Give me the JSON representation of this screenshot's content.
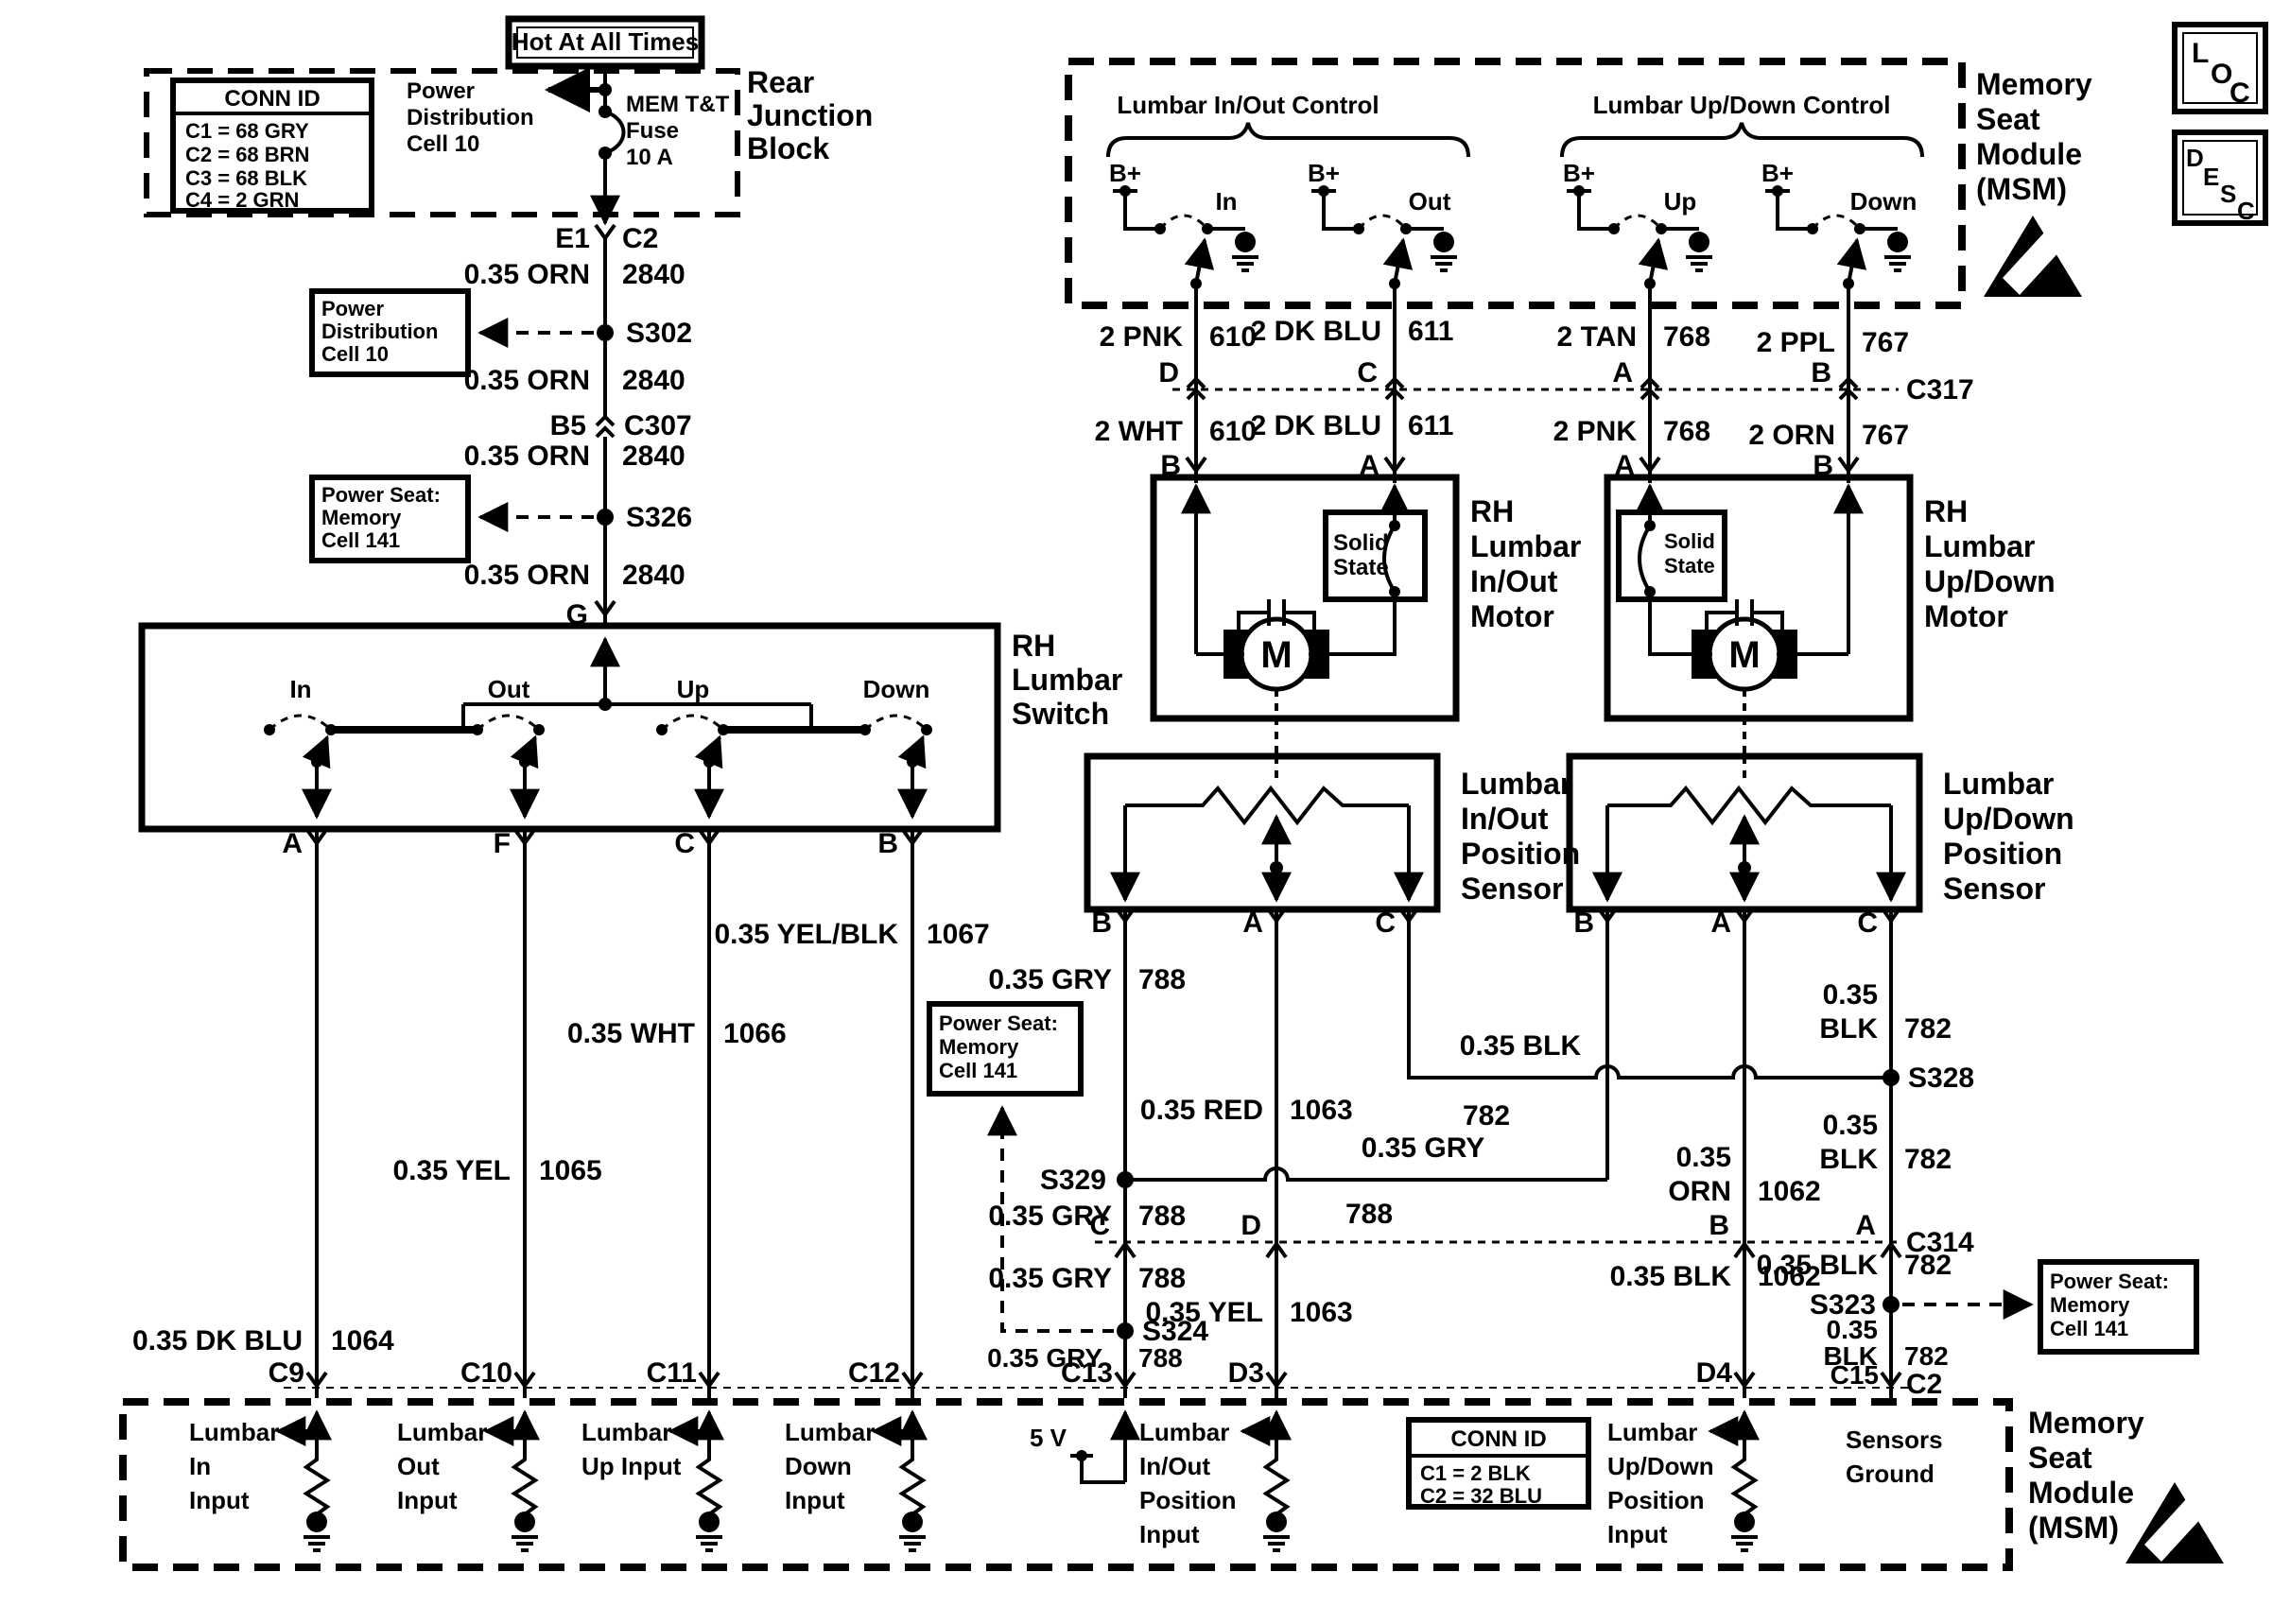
{
  "colors": {
    "ink": "#000000",
    "paper": "#ffffff"
  },
  "nav": {
    "loc": [
      "L",
      "O",
      "C"
    ],
    "desc": [
      "D",
      "E",
      "S",
      "C"
    ]
  },
  "hot_label": "Hot At All Times",
  "pd_cell": [
    "Power",
    "Distribution",
    "Cell 10"
  ],
  "ps_cell": [
    "Power Seat:",
    "Memory",
    "Cell 141"
  ],
  "rjb": {
    "title": [
      "Rear",
      "Junction",
      "Block"
    ],
    "conn_id": {
      "header": "CONN ID",
      "rows": [
        "C1 = 68 GRY",
        "C2 = 68 BRN",
        "C3 = 68 BLK",
        "C4 = 2 GRN"
      ]
    },
    "fuse": [
      "MEM T&T",
      "Fuse",
      "10 A"
    ]
  },
  "feed": {
    "pins_c2": {
      "left": "E1",
      "right": "C2"
    },
    "wire": "0.35 ORN",
    "circuit": "2840",
    "s302": "S302",
    "s326": "S326",
    "c307": {
      "left": "B5",
      "right": "C307"
    },
    "g": "G"
  },
  "sw": {
    "title": [
      "RH",
      "Lumbar",
      "Switch"
    ],
    "positions": [
      "In",
      "Out",
      "Up",
      "Down"
    ],
    "pins": [
      "A",
      "F",
      "C",
      "B"
    ],
    "wires": [
      {
        "label": "0.35 DK BLU",
        "circuit": "1064"
      },
      {
        "label": "0.35 YEL",
        "circuit": "1065"
      },
      {
        "label": "0.35 WHT",
        "circuit": "1066"
      },
      {
        "label": "0.35 YEL/BLK",
        "circuit": "1067"
      }
    ]
  },
  "msm_top": {
    "title": [
      "Memory",
      "Seat",
      "Module",
      "(MSM)"
    ],
    "groups": [
      {
        "label": "Lumbar In/Out Control"
      },
      {
        "label": "Lumbar Up/Down Control"
      }
    ],
    "b_plus": "B+",
    "positions": [
      "In",
      "Out",
      "Up",
      "Down"
    ]
  },
  "c317": {
    "name": "C317",
    "pins": [
      "D",
      "C",
      "A",
      "B"
    ]
  },
  "upper_wires": [
    {
      "label": "2 PNK",
      "circuit": "610"
    },
    {
      "label": "2 DK BLU",
      "circuit": "611"
    },
    {
      "label": "2 TAN",
      "circuit": "768"
    },
    {
      "label": "2 PPL",
      "circuit": "767"
    }
  ],
  "lower_wires": [
    {
      "label": "2 WHT",
      "circuit": "610"
    },
    {
      "label": "2 DK BLU",
      "circuit": "611"
    },
    {
      "label": "2 PNK",
      "circuit": "768"
    },
    {
      "label": "2 ORN",
      "circuit": "767"
    }
  ],
  "motor_pins": [
    "B",
    "A",
    "A",
    "B"
  ],
  "motors": [
    {
      "title": [
        "RH",
        "Lumbar",
        "In/Out",
        "Motor"
      ],
      "solid_state": [
        "Solid",
        "State"
      ],
      "m": "M"
    },
    {
      "title": [
        "RH",
        "Lumbar",
        "Up/Down",
        "Motor"
      ],
      "solid_state": [
        "Solid",
        "State"
      ],
      "m": "M"
    }
  ],
  "sensors": [
    {
      "title": [
        "Lumbar",
        "In/Out",
        "Position",
        "Sensor"
      ],
      "pins": [
        "B",
        "A",
        "C"
      ]
    },
    {
      "title": [
        "Lumbar",
        "Up/Down",
        "Position",
        "Sensor"
      ],
      "pins": [
        "B",
        "A",
        "C"
      ]
    }
  ],
  "mid": {
    "gry": {
      "label": "0.35 GRY",
      "circuit": "788"
    },
    "red": {
      "label": "0.35 RED",
      "circuit": "1063"
    },
    "yel": {
      "label": "0.35 YEL",
      "circuit": "1063"
    },
    "blk782": {
      "label": "0.35 BLK",
      "circuit": "782",
      "w1": "0.35",
      "w2": "BLK"
    },
    "orn1062": {
      "w1": "0.35",
      "w2": "ORN",
      "circuit": "1062"
    },
    "blk1062": {
      "label": "0.35 BLK",
      "circuit": "1062"
    },
    "splices": {
      "s329": "S329",
      "s324": "S324",
      "s328": "S328",
      "s323": "S323"
    }
  },
  "c314": {
    "name": "C314",
    "pins": [
      "C",
      "D",
      "B",
      "A"
    ]
  },
  "msm_bot": {
    "title": [
      "Memory",
      "Seat",
      "Module",
      "(MSM)"
    ],
    "pins": [
      "C9",
      "C10",
      "C11",
      "C12",
      "C13",
      "D3",
      "D4",
      "C15"
    ],
    "conn": "C2",
    "five_v": "5 V",
    "in_in": [
      "Lumbar",
      "In",
      "Input"
    ],
    "in_out": [
      "Lumbar",
      "Out",
      "Input"
    ],
    "in_up": [
      "Lumbar",
      "Up Input"
    ],
    "in_down": [
      "Lumbar",
      "Down",
      "Input"
    ],
    "pos_io": [
      "Lumbar",
      "In/Out",
      "Position",
      "Input"
    ],
    "pos_ud": [
      "Lumbar",
      "Up/Down",
      "Position",
      "Input"
    ],
    "sens_gnd": [
      "Sensors",
      "Ground"
    ],
    "conn_id": {
      "header": "CONN ID",
      "rows": [
        "C1 = 2 BLK",
        "C2 = 32 BLU"
      ]
    }
  }
}
